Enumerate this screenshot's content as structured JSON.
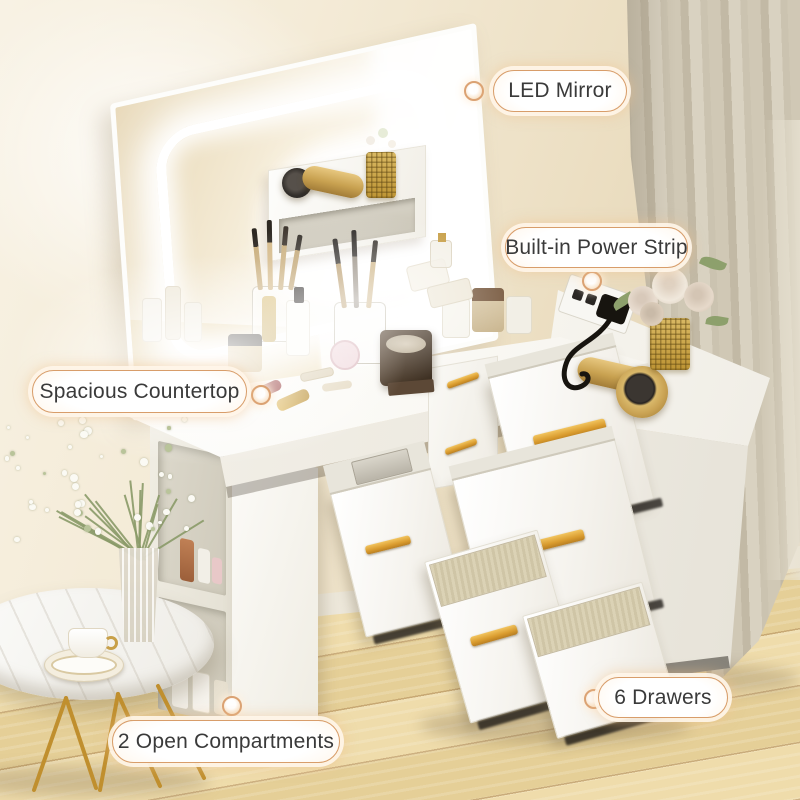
{
  "callouts": [
    {
      "id": "led-mirror",
      "label": "LED Mirror",
      "pill": {
        "x": 493,
        "y": 70,
        "w": 134,
        "h": 42
      },
      "dot": {
        "x": 474,
        "y": 91
      }
    },
    {
      "id": "built-in-power-strip",
      "label": "Built-in Power Strip",
      "pill": {
        "x": 505,
        "y": 227,
        "w": 183,
        "h": 41
      },
      "dot": {
        "x": 592,
        "y": 281
      }
    },
    {
      "id": "spacious-countertop",
      "label": "Spacious Countertop",
      "pill": {
        "x": 32,
        "y": 370,
        "w": 215,
        "h": 43
      },
      "dot": {
        "x": 261,
        "y": 395
      }
    },
    {
      "id": "open-compartments",
      "label": "2 Open Compartments",
      "pill": {
        "x": 112,
        "y": 720,
        "w": 228,
        "h": 43
      },
      "dot": {
        "x": 232,
        "y": 706
      }
    },
    {
      "id": "six-drawers",
      "label": "6 Drawers",
      "pill": {
        "x": 598,
        "y": 677,
        "w": 130,
        "h": 41
      },
      "dot": {
        "x": 594,
        "y": 699
      }
    }
  ],
  "colors": {
    "accent_gold": "#d9a04e",
    "handle_gold": "#e0a83c",
    "pill_border": "#d89d6a",
    "pill_glow": "#f8dfc2",
    "pill_text": "#3a3a3a",
    "led_glow": "#ffffff",
    "wall_beige": "#efe3c8",
    "floor_wood": "#ecd8a4",
    "floor_seam": "#c8a97c",
    "curtain_taupe": "#c9c1ae",
    "furniture_white": "#f7f5f0",
    "linen_drawer": "#d6ccae",
    "rose_cream": "#e9ddd0",
    "leaf_green": "#8da06c",
    "copper_bottle": "#b5714e",
    "dark_hardware": "#2b2724"
  },
  "scene": {
    "objects": [
      "led-mirror",
      "vanity-countertop",
      "storage-riser",
      "hair-dryer-on-riser",
      "hair-dryer-on-cabinet",
      "makeup-brush-cups",
      "cosmetic-jars",
      "jewelry-box",
      "lipstick",
      "pink-compact",
      "gold-mesh-vase-roses",
      "gold-mesh-pen-cup",
      "power-strip-with-plug",
      "drawer-chest-six-drawers",
      "right-side-cabinet",
      "open-shelf-two-compartments",
      "skincare-bottles",
      "round-side-table",
      "coffee-cup-saucer",
      "glass-vase-babys-breath",
      "beige-curtain",
      "wood-floor",
      "beige-wall"
    ]
  }
}
